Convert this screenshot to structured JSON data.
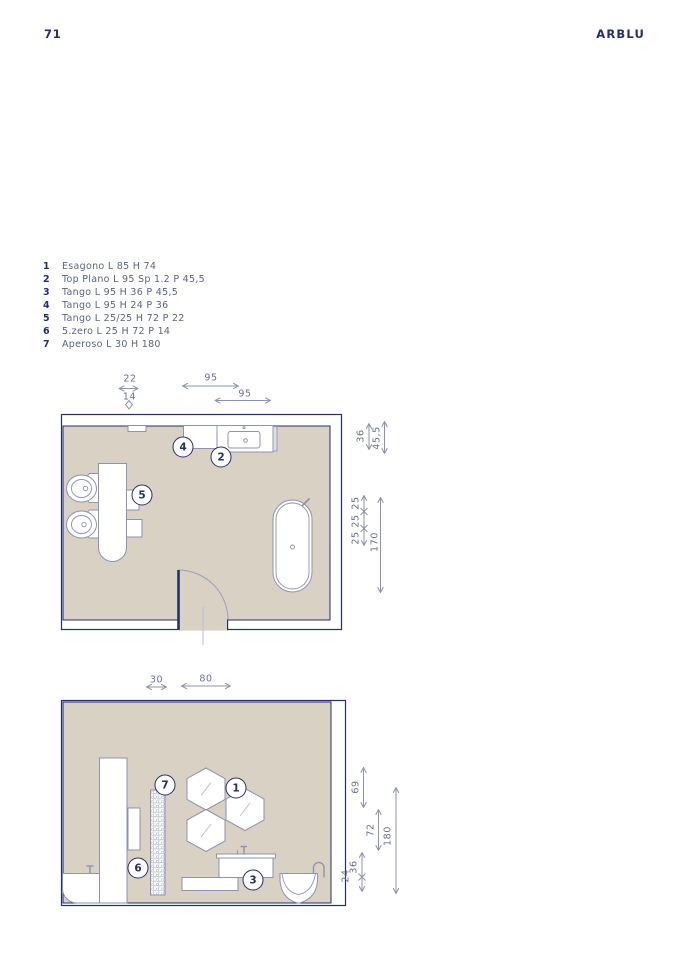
{
  "page": {
    "number": "71",
    "brand": "ARBLU"
  },
  "colors": {
    "navy": "#252f6d",
    "outline": "#8e93af",
    "floor_beige": "#d8d1c4",
    "dim_text": "#6b7195"
  },
  "legend": {
    "items": [
      {
        "num": "1",
        "label": "Esagono L 85 H 74"
      },
      {
        "num": "2",
        "label": "Top Plano L 95 Sp 1.2 P 45,5"
      },
      {
        "num": "3",
        "label": "Tango L 95 H 36 P 45,5"
      },
      {
        "num": "4",
        "label": "Tango L 95 H 24 P 36"
      },
      {
        "num": "5",
        "label": "Tango L 25/25 H 72 P 22"
      },
      {
        "num": "6",
        "label": "5.zero L 25 H 72 P 14"
      },
      {
        "num": "7",
        "label": "Aperoso L 30 H 180"
      }
    ]
  },
  "plan1": {
    "callouts": {
      "c2": "2",
      "c4": "4",
      "c5": "5"
    },
    "dims": {
      "w22": "22",
      "w14": "14",
      "w95a": "95",
      "w95b": "95",
      "h36": "36",
      "h455": "45,5",
      "s25a": "25",
      "s25b": "25",
      "s25c": "25",
      "h170": "170"
    }
  },
  "plan2": {
    "callouts": {
      "c1": "1",
      "c3": "3",
      "c6": "6",
      "c7": "7"
    },
    "dims": {
      "w30": "30",
      "w80": "80",
      "h69": "69",
      "h72": "72",
      "h180": "180",
      "h36": "36",
      "h24": "24"
    }
  }
}
